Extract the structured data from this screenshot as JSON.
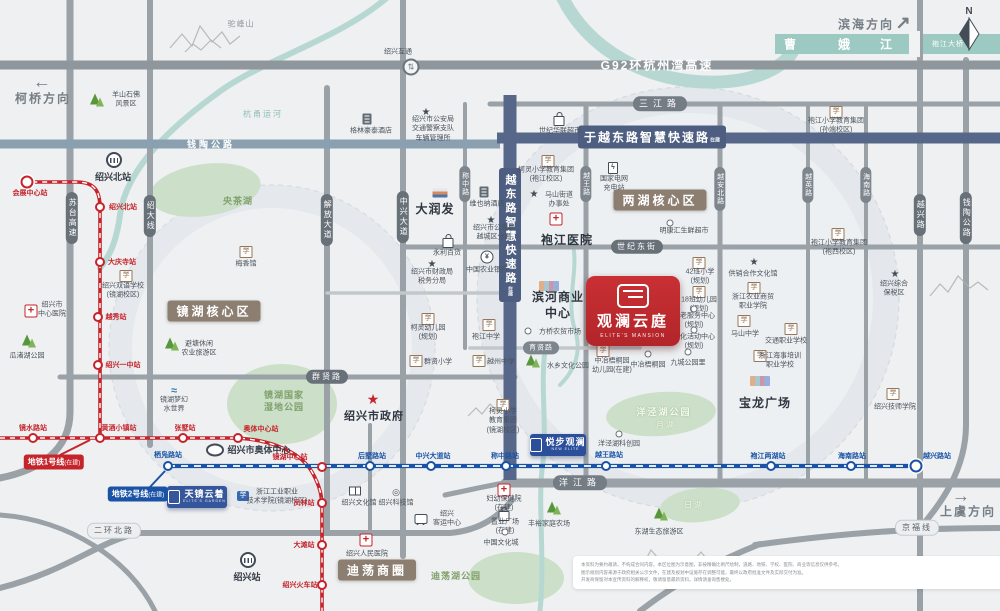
{
  "meta": {
    "width": 1000,
    "height": 611
  },
  "colors": {
    "line1": "#c5242b",
    "line2": "#1a53a5",
    "zone": "#8c7f71",
    "smart_road": "#4d5e80",
    "river": "#b7d8d2",
    "project_red": "#bf2a2c",
    "project_blue": "#35569b"
  },
  "compass": {
    "label": "N"
  },
  "directions": [
    {
      "id": "dir-keqiao",
      "label": "柯桥方向",
      "arrow": "←",
      "tx": 43,
      "ty": 98,
      "ax": 42,
      "ay": 82
    },
    {
      "id": "dir-binhai",
      "label": "滨海方向",
      "arrow": "↗",
      "tx": 866,
      "ty": 24,
      "ax": 903,
      "ay": 23
    },
    {
      "id": "dir-shangyu",
      "label": "上虞方向",
      "arrow": "→",
      "tx": 968,
      "ty": 511,
      "ax": 961,
      "ay": 496
    }
  ],
  "river": {
    "name_chars": [
      "曹",
      "娥",
      "江"
    ],
    "char_xs": [
      790,
      844,
      886
    ],
    "char_y": 44,
    "bridge": "袍江大桥",
    "bridge_x": 948,
    "bridge_y": 44
  },
  "zones": [
    {
      "id": "zone-jinghu",
      "text": "镜湖核心区",
      "x": 214,
      "y": 311
    },
    {
      "id": "zone-lianghu",
      "text": "两湖核心区",
      "x": 660,
      "y": 200
    },
    {
      "id": "zone-didang",
      "text": "迪荡商圈",
      "x": 377,
      "y": 570
    }
  ],
  "roads": {
    "smart_h": {
      "text": "于越东路智慧快速路",
      "sub": "在建",
      "x": 652,
      "y": 137
    },
    "smart_v": {
      "text": "越东路智慧快速路",
      "sub": "在建",
      "x": 510,
      "y": 235
    },
    "onroad": [
      {
        "id": "g92",
        "text": "G92环杭州湾高速",
        "x": 657,
        "y": 65,
        "cls": "hw"
      },
      {
        "id": "qiantao-top",
        "text": "钱陶公路",
        "x": 211,
        "y": 144,
        "cls": "hw2"
      }
    ],
    "pills": [
      {
        "text": "苏台高速",
        "x": 72,
        "y": 218,
        "v": 1
      },
      {
        "text": "绍大线",
        "x": 150,
        "y": 216,
        "v": 1
      },
      {
        "text": "解放大道",
        "x": 327,
        "y": 220,
        "v": 1
      },
      {
        "text": "中兴大道",
        "x": 403,
        "y": 217,
        "v": 1
      },
      {
        "text": "称中路",
        "x": 465,
        "y": 184,
        "v": 1,
        "sm": 1
      },
      {
        "text": "越王路",
        "x": 586,
        "y": 184,
        "v": 1,
        "sm": 1
      },
      {
        "text": "越安北路",
        "x": 720,
        "y": 189,
        "v": 1,
        "sm": 1
      },
      {
        "text": "越英路",
        "x": 808,
        "y": 185,
        "v": 1,
        "sm": 1
      },
      {
        "text": "海南路",
        "x": 866,
        "y": 185,
        "v": 1,
        "sm": 1
      },
      {
        "text": "越兴路",
        "x": 920,
        "y": 215,
        "v": 1
      },
      {
        "text": "钱陶公路",
        "x": 966,
        "y": 218,
        "v": 1
      },
      {
        "text": "三江路",
        "x": 660,
        "y": 104,
        "sp": 1
      },
      {
        "text": "世纪东街",
        "x": 637,
        "y": 247
      },
      {
        "text": "群贤路",
        "x": 327,
        "y": 377
      },
      {
        "text": "育贤路",
        "x": 541,
        "y": 348,
        "sm": 1
      },
      {
        "text": "洋江路",
        "x": 580,
        "y": 483,
        "sp": 1
      },
      {
        "text": "二环北路",
        "x": 114,
        "y": 531,
        "light": 1
      },
      {
        "text": "京福线",
        "x": 917,
        "y": 528,
        "light": 1
      }
    ]
  },
  "metro": {
    "line1": {
      "key": "l1",
      "color": "#c5242b",
      "badge": "地铁1号线",
      "status": "(在建)",
      "bx": 54,
      "by": 462,
      "stations": [
        {
          "name": "会展中心站",
          "x": 27,
          "y": 182,
          "lx": 30,
          "ly": 193,
          "terminal": true
        },
        {
          "name": "绍兴北站",
          "x": 100,
          "y": 207,
          "lx": 123,
          "ly": 207
        },
        {
          "name": "大庆寺站",
          "x": 100,
          "y": 262,
          "lx": 122,
          "ly": 262
        },
        {
          "name": "越秀站",
          "x": 98,
          "y": 317,
          "lx": 116,
          "ly": 317
        },
        {
          "name": "绍兴一中站",
          "x": 98,
          "y": 365,
          "lx": 123,
          "ly": 365
        },
        {
          "name": "镜水路站",
          "x": 33,
          "y": 438,
          "lx": 33,
          "ly": 428
        },
        {
          "name": "黄酒小镇站",
          "x": 100,
          "y": 438,
          "lx": 119,
          "ly": 428
        },
        {
          "name": "张墅站",
          "x": 183,
          "y": 438,
          "lx": 185,
          "ly": 428
        },
        {
          "name": "奥体中心站",
          "x": 238,
          "y": 438,
          "lx": 261,
          "ly": 429
        },
        {
          "name": "镜湖中心站",
          "x": 322,
          "y": 467,
          "lx": 290,
          "ly": 457
        },
        {
          "name": "凤林站",
          "x": 322,
          "y": 503,
          "lx": 304,
          "ly": 503
        },
        {
          "name": "大滩站",
          "x": 322,
          "y": 545,
          "lx": 304,
          "ly": 545
        },
        {
          "name": "绍兴火车站",
          "x": 322,
          "y": 585,
          "lx": 300,
          "ly": 585
        }
      ]
    },
    "line2": {
      "key": "l2",
      "color": "#1a53a5",
      "badge": "地铁2号线",
      "status": "(在建)",
      "bx": 138,
      "by": 494,
      "stations": [
        {
          "name": "栖凫路站",
          "x": 168,
          "y": 466,
          "lx": 168,
          "ly": 455
        },
        {
          "name": "后墅路站",
          "x": 370,
          "y": 466,
          "lx": 372,
          "ly": 456
        },
        {
          "name": "中兴大道站",
          "x": 431,
          "y": 466,
          "lx": 433,
          "ly": 456
        },
        {
          "name": "称中路站",
          "x": 506,
          "y": 466,
          "lx": 505,
          "ly": 456
        },
        {
          "name": "越王路站",
          "x": 606,
          "y": 466,
          "lx": 609,
          "ly": 455
        },
        {
          "name": "袍江两湖站",
          "x": 771,
          "y": 466,
          "lx": 768,
          "ly": 456
        },
        {
          "name": "海南路站",
          "x": 851,
          "y": 466,
          "lx": 852,
          "ly": 456
        },
        {
          "name": "越兴路站",
          "x": 916,
          "y": 466,
          "lx": 937,
          "ly": 456,
          "terminal": true
        }
      ]
    }
  },
  "projects": {
    "main": {
      "name": "观澜云庭",
      "en": "ELITE'S MANSION"
    },
    "tianjing": {
      "name": "天镜云着",
      "en": "ELITE'S GARDEN"
    },
    "yuebu": {
      "name": "悦步观澜",
      "en": "NEW ELITE"
    }
  },
  "pois": [
    {
      "id": "tuofeng-mountain",
      "tx": 241,
      "ty": 25,
      "cls": "gray",
      "lines": [
        "驼峰山"
      ]
    },
    {
      "id": "yangshan-scenic",
      "icon": "tree",
      "ix": 95,
      "iy": 99,
      "tx": 126,
      "ty": 100,
      "lines": [
        "羊山石佛",
        "风景区"
      ]
    },
    {
      "id": "hangyong-canal",
      "tx": 263,
      "ty": 115,
      "cls": "teal",
      "lines": [
        "杭甬运河"
      ]
    },
    {
      "id": "shaoxing-interchange",
      "icon": "inter",
      "ix": 411,
      "iy": 67,
      "tx": 398,
      "ty": 52,
      "lines": [
        "绍兴互通"
      ]
    },
    {
      "id": "greentree-hotel",
      "icon": "hotel",
      "ix": 367,
      "iy": 119,
      "tx": 371,
      "ty": 131,
      "lines": [
        "格林豪泰酒店"
      ]
    },
    {
      "id": "traffic-police",
      "icon": "star",
      "ix": 426,
      "iy": 111,
      "tx": 433,
      "ty": 129,
      "lines": [
        "绍兴市公安局",
        "交通警察支队",
        "车辆管理所"
      ]
    },
    {
      "id": "shiji-hualian",
      "icon": "bag",
      "ix": 559,
      "iy": 118,
      "tx": 560,
      "ty": 131,
      "lines": [
        "世纪华联超市"
      ]
    },
    {
      "id": "paojiang-primary-1",
      "icon": "school",
      "ix": 836,
      "iy": 112,
      "tx": 836,
      "ty": 126,
      "lines": [
        "袍江小学教育集团",
        "(孙端校区)"
      ]
    },
    {
      "id": "sxbei-railway",
      "icon": "train",
      "ix": 114,
      "iy": 160,
      "tx": 113,
      "ty": 177,
      "cls": "b",
      "lines": [
        "绍兴北站"
      ]
    },
    {
      "id": "yangcha-lake",
      "tx": 238,
      "ty": 201,
      "cls": "grn",
      "lines": [
        "央茶湖"
      ]
    },
    {
      "id": "meixiang-hall",
      "icon": "school",
      "ix": 246,
      "iy": 252,
      "tx": 246,
      "ty": 264,
      "lines": [
        "梅香馆"
      ]
    },
    {
      "id": "rt-mart",
      "icon": "store",
      "ix": 440,
      "iy": 193,
      "tx": 435,
      "ty": 209,
      "cls": "big",
      "lines": [
        "大润发"
      ]
    },
    {
      "id": "vienna-hotel",
      "icon": "hotel",
      "ix": 484,
      "iy": 192,
      "tx": 487,
      "ty": 204,
      "lines": [
        "维也纳酒店"
      ]
    },
    {
      "id": "keling-primary-1",
      "icon": "school",
      "ix": 548,
      "iy": 161,
      "tx": 546,
      "ty": 175,
      "lines": [
        "柯灵小学教育集团",
        "(袍江校区)"
      ]
    },
    {
      "id": "ev-charging",
      "icon": "charge",
      "ix": 613,
      "iy": 168,
      "tx": 614,
      "ty": 184,
      "lines": [
        "国家电网",
        "充电站"
      ]
    },
    {
      "id": "mashan-subdistrict",
      "icon": "star",
      "ix": 534,
      "iy": 193,
      "tx": 559,
      "ty": 200,
      "lines": [
        "马山街道",
        "办事处"
      ]
    },
    {
      "id": "paojiang-hospital",
      "icon": "cross",
      "ix": 556,
      "iy": 219,
      "tx": 567,
      "ty": 240,
      "cls": "big",
      "lines": [
        "袍江医院"
      ]
    },
    {
      "id": "police-yuecheng",
      "icon": "star",
      "ix": 491,
      "iy": 219,
      "tx": 494,
      "ty": 233,
      "lines": [
        "绍兴市公安局",
        "越城区分局"
      ]
    },
    {
      "id": "yongli-store",
      "icon": "bag",
      "ix": 448,
      "iy": 240,
      "tx": 447,
      "ty": 253,
      "lines": [
        "永利百货"
      ]
    },
    {
      "id": "abc-bank",
      "icon": "bank",
      "ix": 487,
      "iy": 257,
      "tx": 487,
      "ty": 270,
      "lines": [
        "中国农业银行"
      ]
    },
    {
      "id": "finance-bureau",
      "icon": "star",
      "ix": 432,
      "iy": 263,
      "tx": 432,
      "ty": 277,
      "lines": [
        "绍兴市财政局",
        "税务分局"
      ]
    },
    {
      "id": "mingkanghui",
      "icon": "dot",
      "ix": 670,
      "iy": 223,
      "tx": 684,
      "ty": 231,
      "lines": [
        "明康汇生鲜超市"
      ]
    },
    {
      "id": "paojiang-primary-2",
      "icon": "school",
      "ix": 838,
      "iy": 234,
      "tx": 839,
      "ty": 248,
      "lines": [
        "袍江小学教育集团",
        "(袍西校区)"
      ]
    },
    {
      "id": "bonded-zone",
      "icon": "star",
      "ix": 895,
      "iy": 273,
      "tx": 894,
      "ty": 289,
      "lines": [
        "绍兴综合",
        "保税区"
      ]
    },
    {
      "id": "school-42class",
      "icon": "school",
      "ix": 699,
      "iy": 263,
      "tx": 700,
      "ty": 277,
      "lines": [
        "42班小学",
        "(规划)"
      ]
    },
    {
      "id": "kindergarten-18class",
      "icon": "school",
      "ix": 699,
      "iy": 292,
      "tx": 699,
      "ty": 305,
      "lines": [
        "18班幼儿园",
        "(规划)"
      ]
    },
    {
      "id": "gongxiao-culture",
      "icon": "star",
      "ix": 754,
      "iy": 261,
      "tx": 753,
      "ty": 274,
      "lines": [
        "供销合作文化馆"
      ]
    },
    {
      "id": "nongshang-college",
      "icon": "school",
      "ix": 754,
      "iy": 288,
      "tx": 753,
      "ty": 302,
      "lines": [
        "浙江农业商贸",
        "职业学院"
      ]
    },
    {
      "id": "mashan-middle",
      "icon": "school",
      "ix": 744,
      "iy": 321,
      "tx": 745,
      "ty": 334,
      "lines": [
        "马山中学"
      ]
    },
    {
      "id": "jiaotong-school",
      "icon": "school",
      "ix": 791,
      "iy": 329,
      "tx": 786,
      "ty": 341,
      "lines": [
        "交通职业学校"
      ]
    },
    {
      "id": "haishi-school",
      "icon": "school",
      "ix": 760,
      "iy": 356,
      "tx": 780,
      "ty": 361,
      "lines": [
        "浙江海事培训",
        "职业学校"
      ]
    },
    {
      "id": "elderly-center",
      "icon": "dot",
      "ix": 694,
      "iy": 309,
      "tx": 694,
      "ty": 321,
      "lines": [
        "养老服务中心",
        "(规划)"
      ]
    },
    {
      "id": "culture-activity-center",
      "icon": "dot",
      "ix": 694,
      "iy": 330,
      "tx": 694,
      "ty": 342,
      "lines": [
        "文化活动中心",
        "(规划)"
      ]
    },
    {
      "id": "binhe-business-center",
      "icon": "mall",
      "ix": 549,
      "iy": 286,
      "tx": 558,
      "ty": 305,
      "cls": "big",
      "lines": [
        "滨河商业",
        "中心"
      ]
    },
    {
      "id": "fangqiao-market",
      "icon": "dot",
      "ix": 528,
      "iy": 331,
      "tx": 560,
      "ty": 332,
      "lines": [
        "方桥农贸市场"
      ]
    },
    {
      "id": "shuixiang-park",
      "icon": "tree",
      "ix": 531,
      "iy": 360,
      "tx": 568,
      "ty": 366,
      "lines": [
        "水乡文化公园"
      ]
    },
    {
      "id": "zhongye-kindergarten",
      "icon": "school",
      "ix": 603,
      "iy": 351,
      "tx": 612,
      "ty": 366,
      "lines": [
        "中冶梧桐园",
        "幼儿园(在建)"
      ]
    },
    {
      "id": "zhongye-park",
      "icon": "dot",
      "ix": 648,
      "iy": 354,
      "tx": 648,
      "ty": 365,
      "lines": [
        "中冶梧桐园"
      ]
    },
    {
      "id": "jiucheng-park",
      "icon": "dot",
      "ix": 688,
      "iy": 352,
      "tx": 688,
      "ty": 363,
      "lines": [
        "九城公园里"
      ]
    },
    {
      "id": "jinghu-wetland",
      "tx": 284,
      "ty": 401,
      "cls": "grn",
      "lines": [
        "镜湖国家",
        "湿地公园"
      ]
    },
    {
      "id": "city-government",
      "icon": "starred",
      "ix": 373,
      "iy": 400,
      "tx": 374,
      "ty": 417,
      "cls": "b2",
      "lines": [
        "绍兴市政府"
      ]
    },
    {
      "id": "keling-kindergarten",
      "icon": "school",
      "ix": 428,
      "iy": 319,
      "tx": 428,
      "ty": 333,
      "lines": [
        "柯灵幼儿园",
        "(规划)"
      ]
    },
    {
      "id": "paojiang-middle",
      "icon": "school",
      "ix": 489,
      "iy": 325,
      "tx": 486,
      "ty": 337,
      "lines": [
        "袍江中学"
      ]
    },
    {
      "id": "qunxian-primary",
      "icon": "school",
      "ix": 416,
      "iy": 361,
      "tx": 438,
      "ty": 362,
      "lines": [
        "群贤小学"
      ]
    },
    {
      "id": "yuezhou-middle",
      "icon": "school",
      "ix": 479,
      "iy": 361,
      "tx": 501,
      "ty": 362,
      "lines": [
        "越州中学"
      ]
    },
    {
      "id": "keling-primary-2",
      "icon": "school",
      "ix": 503,
      "iy": 405,
      "tx": 503,
      "ty": 421,
      "lines": [
        "柯灵小学",
        "教育集团",
        "(镜湖校区)"
      ]
    },
    {
      "id": "center-hospital",
      "icon": "cross",
      "ix": 31,
      "iy": 311,
      "tx": 52,
      "ty": 310,
      "lines": [
        "绍兴市",
        "中心医院"
      ]
    },
    {
      "id": "guazhuhu-park",
      "icon": "tree",
      "ix": 27,
      "iy": 340,
      "tx": 27,
      "ty": 356,
      "lines": [
        "瓜渚湖公园"
      ]
    },
    {
      "id": "bitang-agritourism",
      "icon": "tree",
      "ix": 170,
      "iy": 343,
      "tx": 199,
      "ty": 349,
      "lines": [
        "避塘休闲",
        "农业旅游区"
      ]
    },
    {
      "id": "menghuan-waterworld",
      "icon": "water",
      "ix": 174,
      "iy": 390,
      "tx": 174,
      "ty": 405,
      "lines": [
        "镜湖梦幻",
        "水世界"
      ]
    },
    {
      "id": "shuangyu-school",
      "icon": "school",
      "ix": 126,
      "iy": 276,
      "tx": 123,
      "ty": 291,
      "lines": [
        "绍兴双语学校",
        "(镜湖校区)"
      ]
    },
    {
      "id": "aoti-sports-center",
      "icon": "stadium",
      "ix": 215,
      "iy": 450,
      "tx": 259,
      "ty": 450,
      "cls": "b",
      "lines": [
        "绍兴市奥体中心"
      ]
    },
    {
      "id": "zjgy-college",
      "icon": "college",
      "ix": 243,
      "iy": 496,
      "tx": 277,
      "ty": 497,
      "lines": [
        "浙江工业职业",
        "技术学院(镜湖校区)"
      ]
    },
    {
      "id": "shaoxing-railway",
      "icon": "train",
      "ix": 248,
      "iy": 560,
      "tx": 247,
      "ty": 577,
      "cls": "b",
      "lines": [
        "绍兴站"
      ]
    },
    {
      "id": "culture-hall",
      "icon": "book",
      "ix": 355,
      "iy": 491,
      "tx": 359,
      "ty": 503,
      "lines": [
        "绍兴文化馆"
      ]
    },
    {
      "id": "science-hall",
      "icon": "atom",
      "ix": 396,
      "iy": 491,
      "tx": 396,
      "ty": 503,
      "lines": [
        "绍兴科技馆"
      ]
    },
    {
      "id": "renmin-hospital",
      "icon": "cross",
      "ix": 366,
      "iy": 540,
      "tx": 367,
      "ty": 554,
      "lines": [
        "绍兴人民医院"
      ]
    },
    {
      "id": "didang-lake-park",
      "tx": 456,
      "ty": 576,
      "cls": "grn",
      "lines": [
        "迪荡湖公园"
      ]
    },
    {
      "id": "passenger-center",
      "icon": "bus",
      "ix": 421,
      "iy": 519,
      "tx": 447,
      "ty": 519,
      "lines": [
        "绍兴",
        "客运中心"
      ]
    },
    {
      "id": "fuyou-hospital",
      "icon": "cross",
      "ix": 504,
      "iy": 490,
      "tx": 504,
      "ty": 504,
      "lines": [
        "妇幼保健院",
        "(在建)"
      ]
    },
    {
      "id": "zhiye-plaza",
      "icon": "bag",
      "ix": 504,
      "iy": 513,
      "tx": 505,
      "ty": 527,
      "lines": [
        "置业广场",
        "(在建)"
      ]
    },
    {
      "id": "china-culture-city",
      "icon": "dot",
      "ix": 505,
      "iy": 532,
      "tx": 501,
      "ty": 543,
      "lines": [
        "中国文化城"
      ]
    },
    {
      "id": "yangjing-tech-park",
      "icon": "dot",
      "ix": 619,
      "iy": 434,
      "tx": 619,
      "ty": 444,
      "lines": [
        "洋泾湖科创园"
      ]
    },
    {
      "id": "baolong-plaza",
      "icon": "mall",
      "ix": 760,
      "iy": 381,
      "tx": 765,
      "ty": 403,
      "cls": "big",
      "lines": [
        "宝龙广场"
      ]
    },
    {
      "id": "fengyu-farm",
      "icon": "tree",
      "ix": 552,
      "iy": 507,
      "tx": 549,
      "ty": 524,
      "lines": [
        "丰裕家庭农场"
      ]
    },
    {
      "id": "donghu-eco-tourism",
      "icon": "tree",
      "ix": 659,
      "iy": 513,
      "tx": 659,
      "ty": 532,
      "lines": [
        "东湖生态旅游区"
      ]
    },
    {
      "id": "jishi-college",
      "icon": "school",
      "ix": 893,
      "iy": 394,
      "tx": 895,
      "ty": 407,
      "lines": [
        "绍兴技师学院"
      ]
    },
    {
      "id": "yangjinghu-park",
      "tx": 664,
      "ty": 412,
      "cls": "grnw",
      "lines": [
        "洋泾湖公园"
      ]
    },
    {
      "id": "yuehu-lake",
      "tx": 666,
      "ty": 426,
      "cls": "grnw2",
      "lines": [
        "月湖"
      ]
    },
    {
      "id": "rihu-lake",
      "tx": 694,
      "ty": 506,
      "cls": "grnw2",
      "lines": [
        "日湖"
      ]
    }
  ],
  "disclaimer": {
    "lines": [
      "本资料为要约邀请，不构成合同内容。本区位图为示意图，非按精确比例尺绘制，道路、地铁、学校、医院、商业等信息仅供参考。",
      "图示规划内容来源于政府相关公示文件，在建及规划中设施存在调整可能，最终以政府批准文件及实际交付为准。",
      "开发商保留对本宣传资料的解释权，敬请留意最新资料。详情请垂询售楼处。"
    ]
  }
}
